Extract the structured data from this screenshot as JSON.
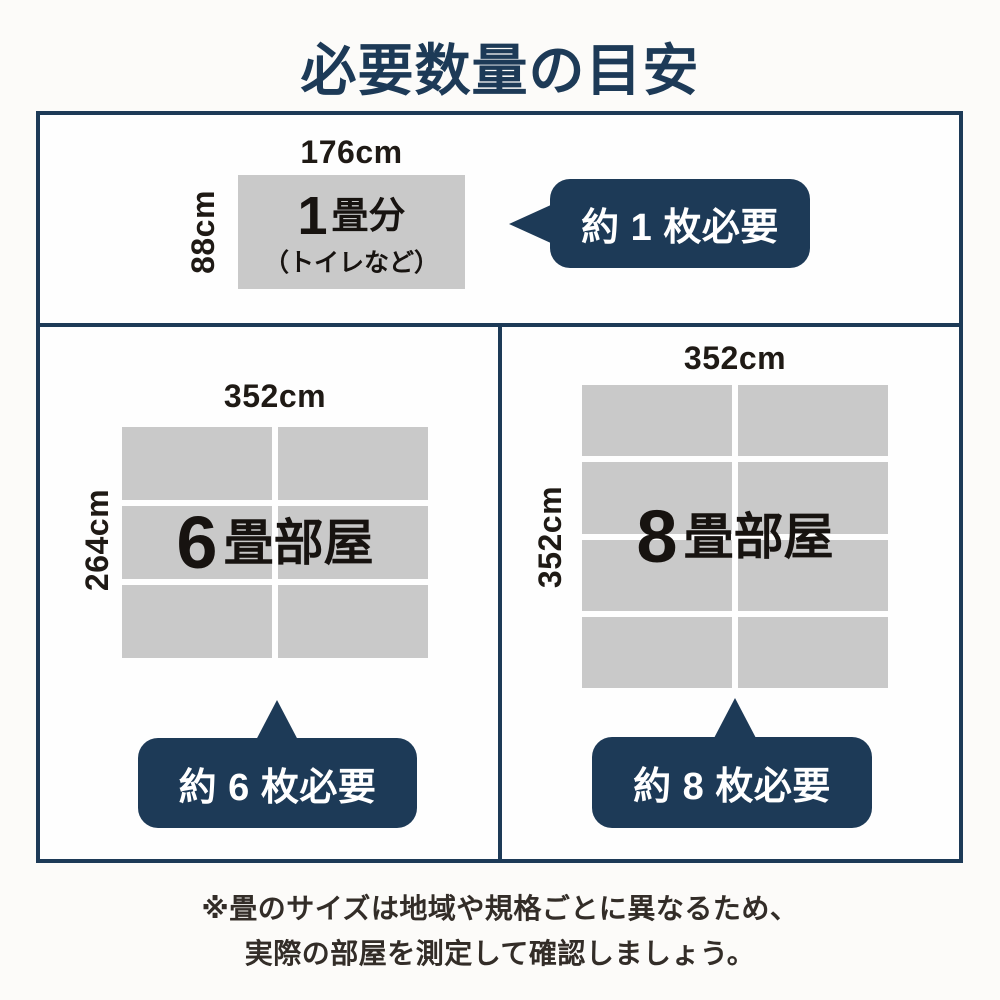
{
  "title": "必要数量の目安",
  "colors": {
    "navy": "#1d3a57",
    "tatami_gray": "#c9c9c9",
    "text_dark": "#171310",
    "note_text": "#332d28"
  },
  "sections": {
    "one_tatami": {
      "width_label": "176cm",
      "height_label": "88cm",
      "room_number": "1",
      "room_suffix": "畳分",
      "room_note": "（トイレなど）",
      "badge": "約 1 枚必要"
    },
    "six_tatami": {
      "width_label": "352cm",
      "height_label": "264cm",
      "room_number": "6",
      "room_suffix": "畳部屋",
      "badge": "約 6 枚必要"
    },
    "eight_tatami": {
      "width_label": "352cm",
      "height_label": "352cm",
      "room_number": "8",
      "room_suffix": "畳部屋",
      "badge": "約 8 枚必要"
    }
  },
  "footnote": {
    "line1": "※畳のサイズは地域や規格ごとに異なるため、",
    "line2": "実際の部屋を測定して確認しましょう。"
  }
}
